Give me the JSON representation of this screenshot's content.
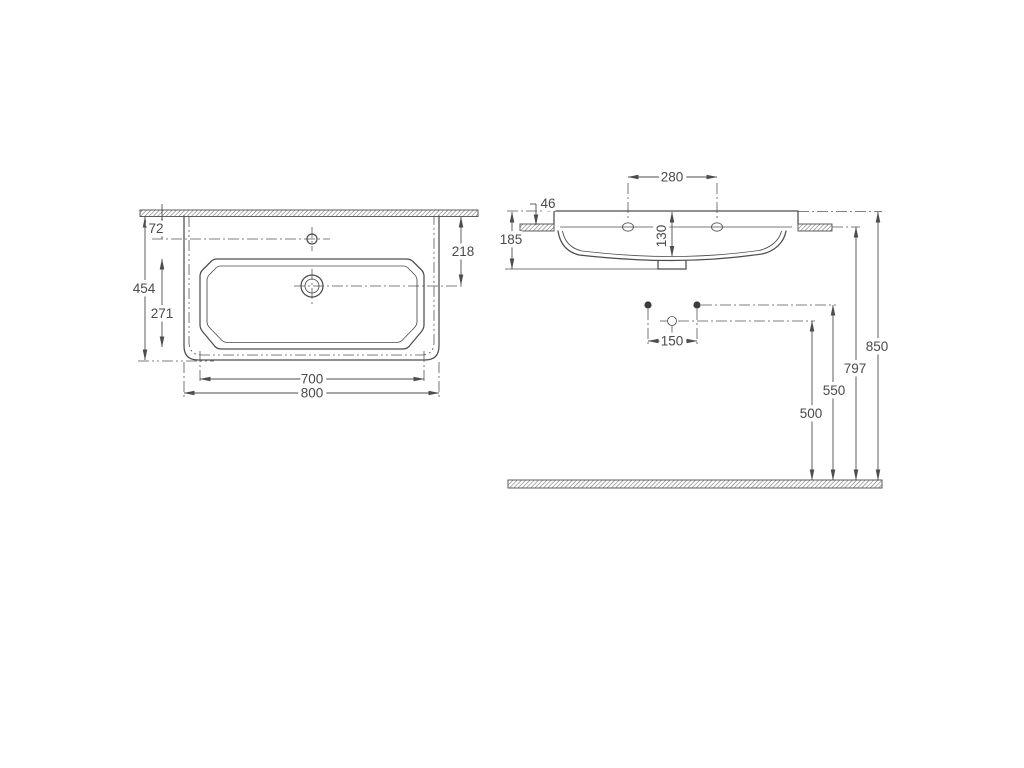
{
  "drawing": {
    "type": "technical-dimension-drawing",
    "subject": "wall-hung washbasin",
    "background": "#ffffff",
    "line_color": "#4d4d4d"
  },
  "plan": {
    "name": "top view",
    "dims": {
      "total_width": "800",
      "bowl_width": "700",
      "total_depth": "454",
      "bowl_depth": "271",
      "faucet_centerline_from_wall": "72",
      "drain_centerline_from_wall": "218"
    }
  },
  "side": {
    "name": "side elevation",
    "dims": {
      "fixing_hole_spacing": "280",
      "rim_to_fixing_holes": "46",
      "basin_height": "185",
      "bowl_inner_depth": "130",
      "bolt_spacing": "150",
      "drain_outlet_height": "500",
      "bolt_height": "550",
      "fixing_hole_height": "797",
      "rim_height": "850"
    }
  }
}
